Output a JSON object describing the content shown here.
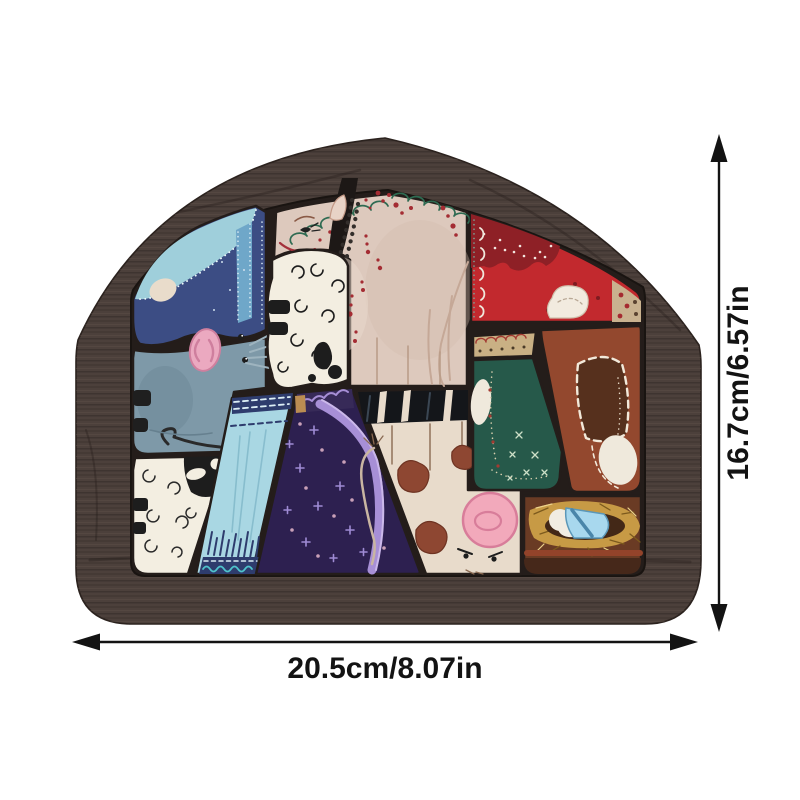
{
  "image_type": "e-commerce product photo with dimension annotations",
  "product": {
    "name": "house-shaped wooden nativity jigsaw puzzle",
    "scene": "folk-art nativity patchwork",
    "pieces": [
      "large cream figure with green scalloped trim",
      "shepherd in blue cloak with light blue drape",
      "gray donkey with pink muzzle",
      "spotted lamb fleece",
      "white sheep with black head",
      "light blue fringed apron",
      "Mary in purple starry robe with lavender ribbon",
      "cream cow with brown patches and pig face",
      "red cloak with dark lace",
      "green apron with tan scalloped band",
      "russet piece with dark brown boot and egg",
      "baby Jesus in straw manger"
    ]
  },
  "dimensions": {
    "width_label": "20.5cm/8.07in",
    "height_label": "16.7cm/6.57in"
  },
  "colors": {
    "background": "#ffffff",
    "arrow": "#131313",
    "label_text": "#131313",
    "frame_wood": "#4c403b",
    "recess": "#241d1a",
    "cream_figure": "#ddc9bd",
    "trim_green": "#2f6b52",
    "accent_red": "#a42c33",
    "blue_cloak": "#3c4d84",
    "drape_blue": "#9fcfdb",
    "donkey_gray": "#7e99a8",
    "muzzle_pink": "#eba9c0",
    "fleece_white": "#f3eee1",
    "apron_blue": "#a9d7e3",
    "apron_navy": "#2e3c6d",
    "teal_wave": "#4fc3cc",
    "robe_purple": "#2d2050",
    "lavender": "#a78fd6",
    "gold_band": "#bb8d52",
    "cow_cream": "#e8dbcb",
    "patch_brown": "#8e4732",
    "belt_black": "#14161a",
    "pig_pink": "#f2a9bb",
    "red_cloak": "#c2292e",
    "lace_red": "#8e2026",
    "tan_trim": "#c9b28f",
    "tan_band": "#c9b084",
    "green_apron": "#26594a",
    "boot_russet": "#93482e",
    "boot_dark": "#56301d",
    "manger_brown": "#6a3b24",
    "straw_gold": "#c79a45",
    "blanket_blue": "#a8d8ee"
  }
}
